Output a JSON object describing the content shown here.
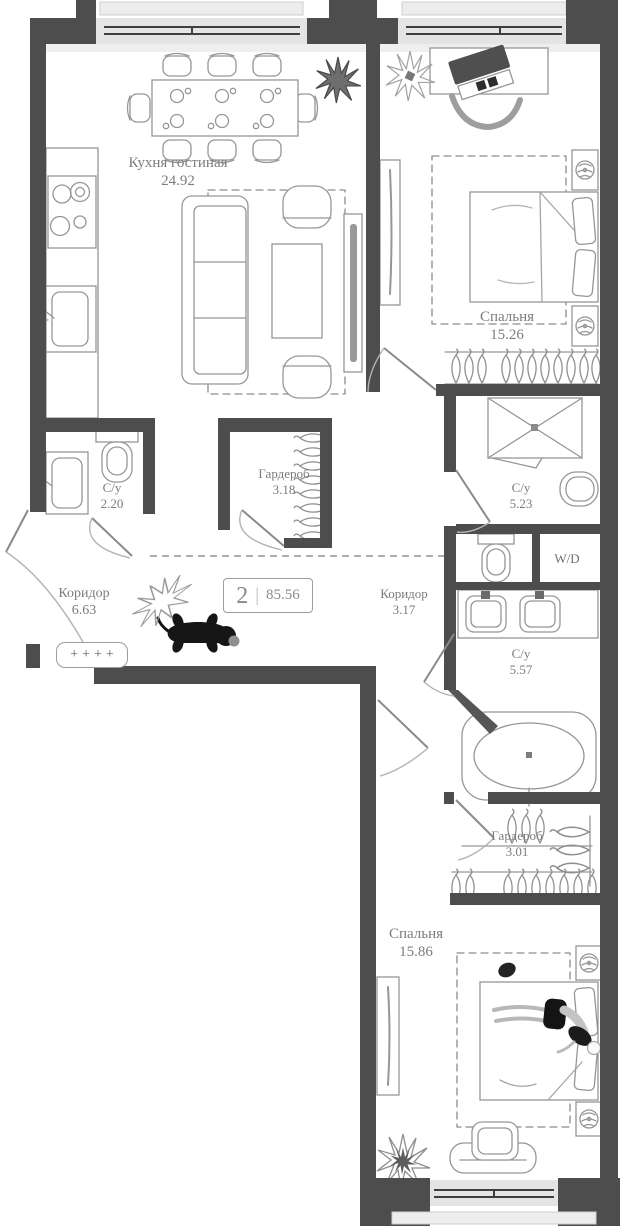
{
  "plan": {
    "badge": {
      "number": "2",
      "divider": "|",
      "total_area": "85.56"
    },
    "rooms": [
      {
        "name": "Кухня гостиная",
        "area": "24.92"
      },
      {
        "name": "Спальня",
        "area": "15.26"
      },
      {
        "name": "Гардероб",
        "area": "3.18"
      },
      {
        "name": "С/у",
        "area": "2.20"
      },
      {
        "name": "С/у",
        "area": "5.23"
      },
      {
        "name": "Коридор",
        "area": "6.63"
      },
      {
        "name": "Коридор",
        "area": "3.17"
      },
      {
        "name": "С/у",
        "area": "5.57"
      },
      {
        "name": "Гардероб",
        "area": "3.01"
      },
      {
        "name": "Спальня",
        "area": "15.86"
      }
    ],
    "labels": {
      "washer_dryer": "W/D",
      "shoe_rack": "++++"
    },
    "colors": {
      "wall": "#4d4d4d",
      "furniture_stroke": "#969696",
      "window_fill": "#e4e4e4",
      "label_text": "#7c7c7c",
      "background": "#ffffff"
    }
  }
}
